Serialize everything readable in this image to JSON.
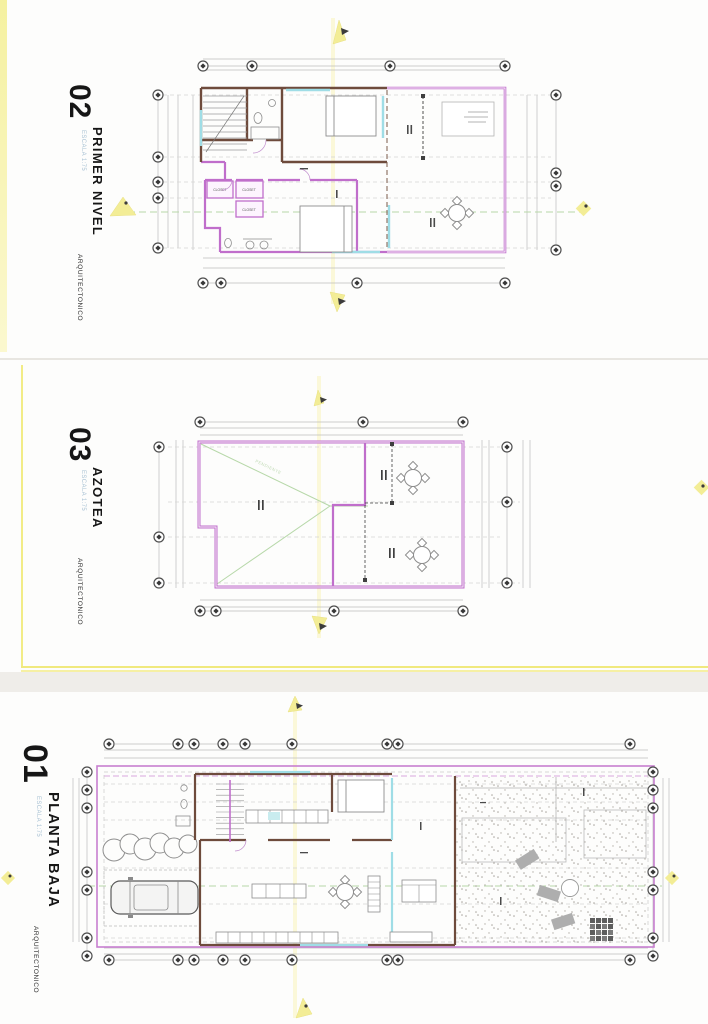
{
  "sheets": [
    {
      "number": "02",
      "title": "PRIMER NIVEL",
      "scale": "ESCALA 1:75",
      "discipline": "ARQUITECTONICO"
    },
    {
      "number": "03",
      "title": "AZOTEA",
      "scale": "ESCALA 1:75",
      "discipline": "ARQUITECTONICO"
    },
    {
      "number": "01",
      "title": "PLANTA BAJA",
      "scale": "ESCALA 1:75",
      "discipline": "ARQUITECTONICO"
    }
  ],
  "plan_annotations": {
    "closet_a": "CLOSET",
    "closet_b": "CLOSET",
    "closet_c": "CLOSET",
    "roof_slope": "PENDIENTE"
  },
  "colors": {
    "wall_magenta": "#c06ecb",
    "wall_dark": "#6e4b3c",
    "accent_cyan": "#9fdde6",
    "centerline_green": "#b7d8a9",
    "highlight_yellow": "#f3ed96"
  }
}
